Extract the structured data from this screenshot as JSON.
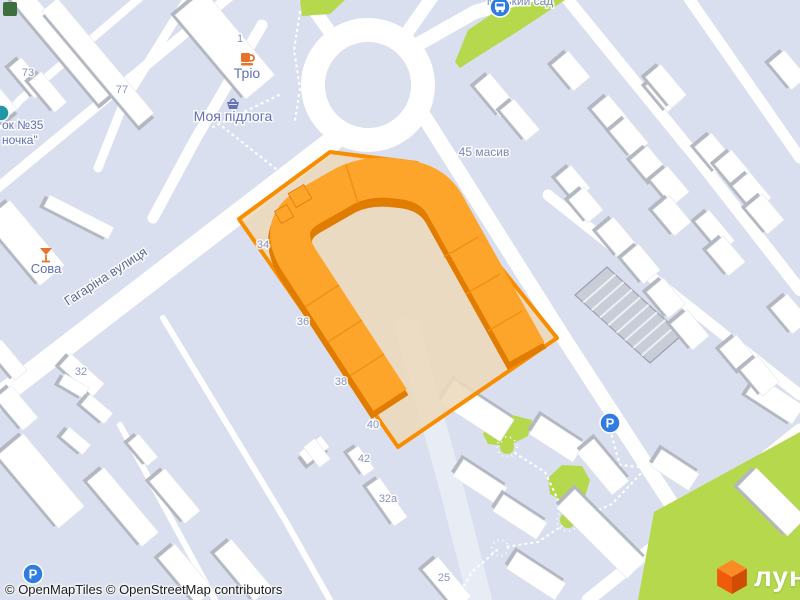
{
  "attribution": {
    "openmaptiles": "© OpenMapTiles",
    "osm": "© OpenStreetMap contributors"
  },
  "logo": {
    "text": "лун",
    "cube_top": "#fb8b24",
    "cube_left": "#ef5a0d",
    "cube_right": "#cf4d05"
  },
  "map": {
    "width": 800,
    "height": 600,
    "colors": {
      "bg": "#d9dfee",
      "road": "#ffffff",
      "road_minor": "#e8ecf5",
      "island": "#dbe0ee",
      "green": "#b5d84d",
      "green_dark": "#3e6f3f",
      "bld": "#ffffff",
      "bld_shadow": "#b3b7bf",
      "bld_stroke": "#e2e5ec",
      "hatch_fill": "#c9cdd8",
      "hatch_line": "#eef0f6",
      "hatch_stroke": "#9aa0ac",
      "hl_fill": "#ecd9bc",
      "hl_stroke": "#f98d00",
      "u_top": "#fda42a",
      "u_side": "#e07c00",
      "u_tick": "#ef9212",
      "dotted": "#ffffff",
      "label_num": "#8a93c0",
      "label_poi": "#6470b4",
      "label_street": "#616a90",
      "label_place": "#7d87b5",
      "icon_blue": "#2f7de1",
      "icon_orange": "#e8722b",
      "icon_purple": "#6673b3",
      "icon_teal": "#1f97a5"
    },
    "roads": [
      {
        "p": [
          [
            352,
            126
          ],
          [
            -20,
            412
          ]
        ],
        "w": 21
      },
      {
        "p": [
          [
            337,
            42
          ],
          [
            300,
            -10
          ]
        ],
        "w": 13
      },
      {
        "p": [
          [
            402,
            40
          ],
          [
            437,
            -10
          ]
        ],
        "w": 13
      },
      {
        "p": [
          [
            408,
            50
          ],
          [
            475,
            12
          ],
          [
            545,
            -8
          ]
        ],
        "w": 14
      },
      {
        "p": [
          [
            425,
            118
          ],
          [
            565,
            340
          ],
          [
            700,
            548
          ],
          [
            733,
            600
          ]
        ],
        "w": 15
      },
      {
        "p": [
          [
            560,
            -10
          ],
          [
            700,
            162
          ],
          [
            800,
            290
          ]
        ],
        "w": 12
      },
      {
        "p": [
          [
            683,
            -10
          ],
          [
            800,
            158
          ]
        ],
        "w": 11
      },
      {
        "p": [
          [
            548,
            195
          ],
          [
            800,
            395
          ]
        ],
        "w": 11
      },
      {
        "p": [
          [
            588,
            600
          ],
          [
            800,
            430
          ]
        ],
        "w": 13
      },
      {
        "p": [
          [
            408,
            330
          ],
          [
            452,
            490
          ],
          [
            480,
            600
          ]
        ],
        "w": 24,
        "minor": true
      },
      {
        "p": [
          [
            163,
            318
          ],
          [
            285,
            520
          ],
          [
            330,
            600
          ]
        ],
        "w": 6
      },
      {
        "p": [
          [
            120,
            425
          ],
          [
            215,
            600
          ]
        ],
        "w": 6
      },
      {
        "p": [
          [
            143,
            -5
          ],
          [
            20,
            100
          ],
          [
            -5,
            130
          ]
        ],
        "w": 8
      },
      {
        "p": [
          [
            190,
            -5
          ],
          [
            125,
            100
          ],
          [
            98,
            168
          ]
        ],
        "w": 9
      },
      {
        "p": [
          [
            235,
            -8
          ],
          [
            -5,
            190
          ]
        ],
        "w": 10
      },
      {
        "p": [
          [
            262,
            25
          ],
          [
            195,
            140
          ],
          [
            153,
            218
          ]
        ],
        "w": 11
      }
    ],
    "roundabout": {
      "cx": 368,
      "cy": 85,
      "r": 55,
      "ring": 24,
      "island": 43
    },
    "greens": [
      [
        [
          455,
          62
        ],
        [
          468,
          30
        ],
        [
          495,
          12
        ],
        [
          540,
          0
        ],
        [
          565,
          0
        ],
        [
          520,
          30
        ],
        [
          480,
          55
        ],
        [
          460,
          68
        ]
      ],
      [
        [
          300,
          0
        ],
        [
          345,
          0
        ],
        [
          330,
          14
        ],
        [
          302,
          16
        ]
      ],
      [
        [
          483,
          434
        ],
        [
          492,
          420
        ],
        [
          512,
          415
        ],
        [
          532,
          420
        ],
        [
          528,
          436
        ],
        [
          508,
          446
        ],
        [
          488,
          444
        ]
      ],
      [
        [
          548,
          478
        ],
        [
          562,
          465
        ],
        [
          582,
          466
        ],
        [
          590,
          480
        ],
        [
          585,
          497
        ],
        [
          566,
          503
        ],
        [
          550,
          494
        ]
      ],
      [
        [
          638,
          600
        ],
        [
          654,
          512
        ],
        [
          800,
          432
        ],
        [
          800,
          600
        ]
      ]
    ],
    "green_circles": [
      [
        507,
        447,
        7
      ],
      [
        568,
        520,
        8
      ]
    ],
    "white_circles": [
      [
        500,
        548,
        8
      ]
    ],
    "dotted_paths": [
      [
        [
          213,
          127
        ],
        [
          283,
          93
        ]
      ],
      [
        [
          223,
          127
        ],
        [
          305,
          192
        ]
      ],
      [
        [
          300,
          12
        ],
        [
          294,
          50
        ],
        [
          300,
          88
        ],
        [
          295,
          120
        ]
      ],
      [
        [
          455,
          405
        ],
        [
          490,
          432
        ],
        [
          505,
          445
        ]
      ],
      [
        [
          510,
          450
        ],
        [
          545,
          472
        ],
        [
          565,
          515
        ]
      ],
      [
        [
          572,
          522
        ],
        [
          612,
          504
        ],
        [
          648,
          466
        ]
      ],
      [
        [
          563,
          525
        ],
        [
          538,
          542
        ],
        [
          505,
          547
        ]
      ],
      [
        [
          497,
          550
        ],
        [
          472,
          572
        ],
        [
          460,
          592
        ]
      ],
      [
        [
          610,
          430
        ],
        [
          620,
          465
        ],
        [
          648,
          468
        ]
      ]
    ],
    "hatch": {
      "corners": [
        [
          575,
          295
        ],
        [
          607,
          267
        ],
        [
          682,
          335
        ],
        [
          650,
          363
        ]
      ],
      "stripes": 8
    },
    "buildings": [
      [
        58,
        40,
        150,
        20,
        50,
        4,
        3
      ],
      [
        98,
        62,
        150,
        20,
        50,
        4,
        3
      ],
      [
        225,
        45,
        110,
        38,
        50,
        -4,
        3
      ],
      [
        28,
        78,
        40,
        16,
        50,
        -4,
        3
      ],
      [
        48,
        92,
        40,
        16,
        50,
        -4,
        3
      ],
      [
        -5,
        98,
        45,
        20,
        50,
        4,
        3
      ],
      [
        79,
        217,
        72,
        13,
        27,
        -4,
        3
      ],
      [
        25,
        243,
        85,
        32,
        50,
        -4,
        3
      ],
      [
        8,
        360,
        40,
        16,
        50,
        -4,
        3
      ],
      [
        82,
        375,
        45,
        17,
        42,
        -4,
        3
      ],
      [
        17,
        408,
        42,
        20,
        50,
        -4,
        3
      ],
      [
        74,
        386,
        28,
        12,
        30,
        -4,
        3
      ],
      [
        97,
        409,
        30,
        14,
        40,
        -4,
        3
      ],
      [
        76,
        441,
        28,
        13,
        40,
        -4,
        3
      ],
      [
        41,
        481,
        95,
        34,
        50,
        -4,
        3
      ],
      [
        123,
        507,
        85,
        22,
        50,
        -4,
        3
      ],
      [
        143,
        450,
        30,
        14,
        50,
        -4,
        3
      ],
      [
        175,
        496,
        55,
        20,
        50,
        -4,
        3
      ],
      [
        186,
        574,
        60,
        22,
        50,
        -4,
        3
      ],
      [
        243,
        570,
        62,
        22,
        50,
        -4,
        3
      ],
      [
        314,
        450,
        28,
        14,
        -38,
        -4,
        3
      ],
      [
        317,
        453,
        14,
        26,
        -38,
        0,
        0
      ],
      [
        361,
        461,
        28,
        13,
        55,
        -4,
        3
      ],
      [
        387,
        502,
        48,
        16,
        55,
        -4,
        3
      ],
      [
        447,
        583,
        52,
        20,
        50,
        -4,
        3
      ],
      [
        477,
        411,
        72,
        26,
        33,
        -4,
        -3
      ],
      [
        557,
        439,
        52,
        22,
        33,
        -4,
        -3
      ],
      [
        603,
        467,
        55,
        22,
        50,
        -4,
        -3
      ],
      [
        480,
        482,
        52,
        20,
        33,
        -4,
        -3
      ],
      [
        520,
        517,
        52,
        20,
        33,
        -4,
        -3
      ],
      [
        601,
        534,
        100,
        26,
        45,
        -4,
        -3
      ],
      [
        536,
        576,
        58,
        20,
        33,
        -4,
        -3
      ],
      [
        775,
        400,
        55,
        22,
        33,
        -4,
        3
      ],
      [
        675,
        470,
        45,
        20,
        33,
        -4,
        -3
      ],
      [
        772,
        502,
        70,
        26,
        45,
        -4,
        3
      ],
      [
        571,
        71,
        34,
        22,
        50,
        -4,
        3
      ],
      [
        611,
        115,
        34,
        22,
        50,
        -4,
        3
      ],
      [
        629,
        137,
        34,
        22,
        50,
        -4,
        3
      ],
      [
        650,
        166,
        34,
        22,
        50,
        -4,
        3
      ],
      [
        670,
        186,
        34,
        22,
        50,
        -4,
        3
      ],
      [
        672,
        216,
        34,
        22,
        50,
        -4,
        3
      ],
      [
        665,
        92,
        34,
        22,
        50,
        -4,
        3
      ],
      [
        714,
        153,
        34,
        22,
        50,
        -4,
        3
      ],
      [
        734,
        170,
        34,
        22,
        50,
        -4,
        3
      ],
      [
        752,
        192,
        34,
        22,
        50,
        -4,
        3
      ],
      [
        765,
        214,
        34,
        22,
        50,
        -4,
        3
      ],
      [
        616,
        237,
        34,
        22,
        50,
        -4,
        3
      ],
      [
        641,
        264,
        34,
        22,
        50,
        -4,
        3
      ],
      [
        666,
        298,
        34,
        22,
        50,
        -4,
        3
      ],
      [
        690,
        330,
        34,
        22,
        50,
        -4,
        3
      ],
      [
        715,
        231,
        40,
        18,
        50,
        -4,
        3
      ],
      [
        726,
        256,
        34,
        22,
        50,
        -4,
        3
      ],
      [
        739,
        355,
        34,
        22,
        50,
        -4,
        3
      ],
      [
        760,
        376,
        34,
        22,
        50,
        -4,
        3
      ],
      [
        790,
        314,
        34,
        22,
        50,
        -4,
        3
      ],
      [
        573,
        183,
        30,
        20,
        50,
        -4,
        3
      ],
      [
        586,
        205,
        30,
        20,
        50,
        -4,
        3
      ],
      [
        495,
        95,
        40,
        20,
        50,
        -4,
        3
      ],
      [
        520,
        120,
        40,
        18,
        50,
        -4,
        3
      ],
      [
        666,
        86,
        40,
        20,
        50,
        -4,
        3
      ],
      [
        788,
        70,
        35,
        20,
        50,
        -4,
        3
      ]
    ],
    "highlight": {
      "outline": [
        [
          239,
          219
        ],
        [
          330,
          152
        ],
        [
          417,
          163
        ],
        [
          557,
          338
        ],
        [
          398,
          447
        ]
      ],
      "u_path": "M 390,400 L 300,262 Q 276,225 310,206 L 345,186 Q 365,176 390,178 L 400,179 Q 432,182 445,205 L 527,352",
      "u_width": 40,
      "blocks": [
        [
          300,
          196,
          18,
          16,
          -30
        ],
        [
          284,
          214,
          14,
          14,
          -30
        ]
      ],
      "ticks": [
        [
          305,
          307,
          339,
          285
        ],
        [
          328,
          342,
          362,
          320
        ],
        [
          350,
          376,
          384,
          354
        ],
        [
          444,
          257,
          478,
          237
        ],
        [
          466,
          294,
          500,
          274
        ],
        [
          488,
          331,
          522,
          311
        ],
        [
          346,
          165,
          358,
          203
        ]
      ]
    },
    "labels": [
      {
        "t": "73",
        "x": 28,
        "y": 76,
        "s": 11,
        "c": "num",
        "n": "housenumber-73"
      },
      {
        "t": "77",
        "x": 122,
        "y": 93,
        "s": 11,
        "c": "num",
        "n": "housenumber-77"
      },
      {
        "t": "1",
        "x": 240,
        "y": 42,
        "s": 11,
        "c": "num",
        "n": "housenumber-1"
      },
      {
        "t": "Тріо",
        "x": 247,
        "y": 78,
        "s": 14,
        "c": "poi",
        "n": "poi-label-trio"
      },
      {
        "t": "Моя підлога",
        "x": 233,
        "y": 121,
        "s": 14,
        "c": "poi",
        "n": "poi-label-moya-pidloha"
      },
      {
        "t": "Сова",
        "x": 46,
        "y": 273,
        "s": 13,
        "c": "poi",
        "n": "poi-label-sova"
      },
      {
        "t": "ок №35",
        "x": 2,
        "y": 129,
        "s": 12,
        "c": "poi",
        "a": "start",
        "n": "poi-label-rynok-35"
      },
      {
        "t": "ночка\"",
        "x": 2,
        "y": 144,
        "s": 12,
        "c": "poi",
        "a": "start",
        "n": "poi-label-nochka"
      },
      {
        "t": "Гагаріна вулиця",
        "x": 108,
        "y": 280,
        "s": 13,
        "c": "street",
        "r": -33,
        "n": "street-label-haharina"
      },
      {
        "t": "45 масив",
        "x": 484,
        "y": 156,
        "s": 12,
        "c": "place",
        "n": "place-label-45-masyv"
      },
      {
        "t": "Міський сад",
        "x": 520,
        "y": 5,
        "s": 12,
        "c": "place",
        "n": "place-label-sad-clipped"
      },
      {
        "t": "34",
        "x": 263,
        "y": 248,
        "s": 11,
        "c": "num",
        "n": "housenumber-34"
      },
      {
        "t": "36",
        "x": 303,
        "y": 325,
        "s": 11,
        "c": "num",
        "n": "housenumber-36"
      },
      {
        "t": "38",
        "x": 341,
        "y": 385,
        "s": 11,
        "c": "num",
        "n": "housenumber-38"
      },
      {
        "t": "40",
        "x": 373,
        "y": 428,
        "s": 11,
        "c": "num",
        "n": "housenumber-40"
      },
      {
        "t": "42",
        "x": 364,
        "y": 462,
        "s": 11,
        "c": "num",
        "n": "housenumber-42"
      },
      {
        "t": "32а",
        "x": 388,
        "y": 502,
        "s": 11,
        "c": "num",
        "n": "housenumber-32a"
      },
      {
        "t": "32",
        "x": 81,
        "y": 375,
        "s": 11,
        "c": "num",
        "n": "housenumber-32"
      },
      {
        "t": "25",
        "x": 444,
        "y": 581,
        "s": 11,
        "c": "num",
        "n": "housenumber-25"
      }
    ],
    "icons": [
      {
        "k": "bus",
        "x": 500,
        "y": 7,
        "n": "bus-stop-icon"
      },
      {
        "k": "cup",
        "x": 247,
        "y": 59,
        "n": "cafe-icon"
      },
      {
        "k": "basket",
        "x": 233,
        "y": 104,
        "n": "shop-icon"
      },
      {
        "k": "cocktail",
        "x": 46,
        "y": 255,
        "n": "bar-icon"
      },
      {
        "k": "teal",
        "x": 1,
        "y": 113,
        "n": "poi-icon"
      },
      {
        "k": "greensq",
        "x": 10,
        "y": 9,
        "n": "park-icon"
      },
      {
        "k": "parking",
        "x": 33,
        "y": 574,
        "n": "parking-icon"
      },
      {
        "k": "parking",
        "x": 610,
        "y": 423,
        "n": "parking-icon"
      }
    ]
  }
}
